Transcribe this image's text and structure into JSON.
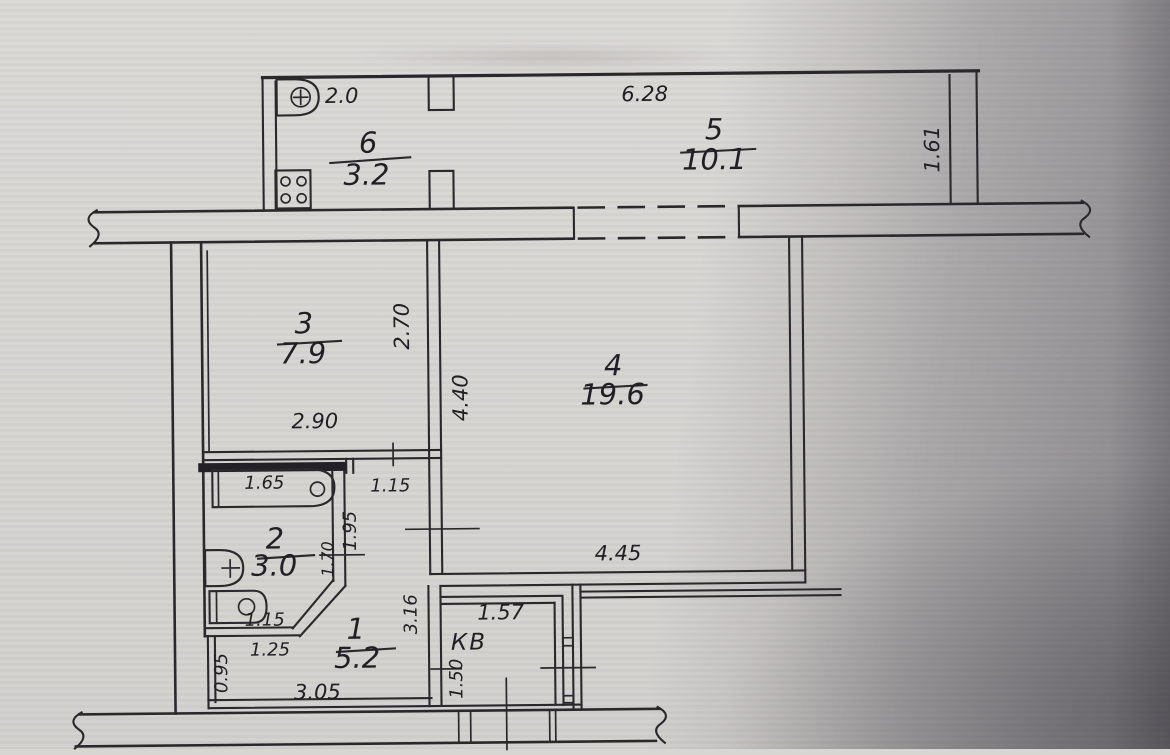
{
  "document": {
    "kind": "scanned apartment floor plan",
    "paper_color": "#d8d6d3",
    "ink_color": "#2a282d"
  },
  "rooms": [
    {
      "number": "1",
      "area": "5.2"
    },
    {
      "number": "2",
      "area": "3.0"
    },
    {
      "number": "3",
      "area": "7.9"
    },
    {
      "number": "4",
      "area": "19.6"
    },
    {
      "number": "5",
      "area": "10.1"
    },
    {
      "number": "6",
      "area": "3.2"
    }
  ],
  "labels": {
    "entry": "КВ"
  },
  "dimensions": {
    "kitchen_balcony_width": "2.0",
    "loggia_length": "6.28",
    "loggia_depth": "1.61",
    "room3_depth": "2.70",
    "room3_width": "2.90",
    "room4_depth": "4.40",
    "room4_width": "4.45",
    "bathtub_length": "1.65",
    "hall_top_width": "1.15",
    "hall_side_depth": "1.95",
    "bath_door_side": "1.70",
    "toilet_width": "1.15",
    "hall_lower_width": "1.25",
    "hall_left_depth": "0.95",
    "hall_length": "3.05",
    "hall_right_depth": "3.16",
    "entry_width": "1.57",
    "entry_depth": "1.50"
  }
}
